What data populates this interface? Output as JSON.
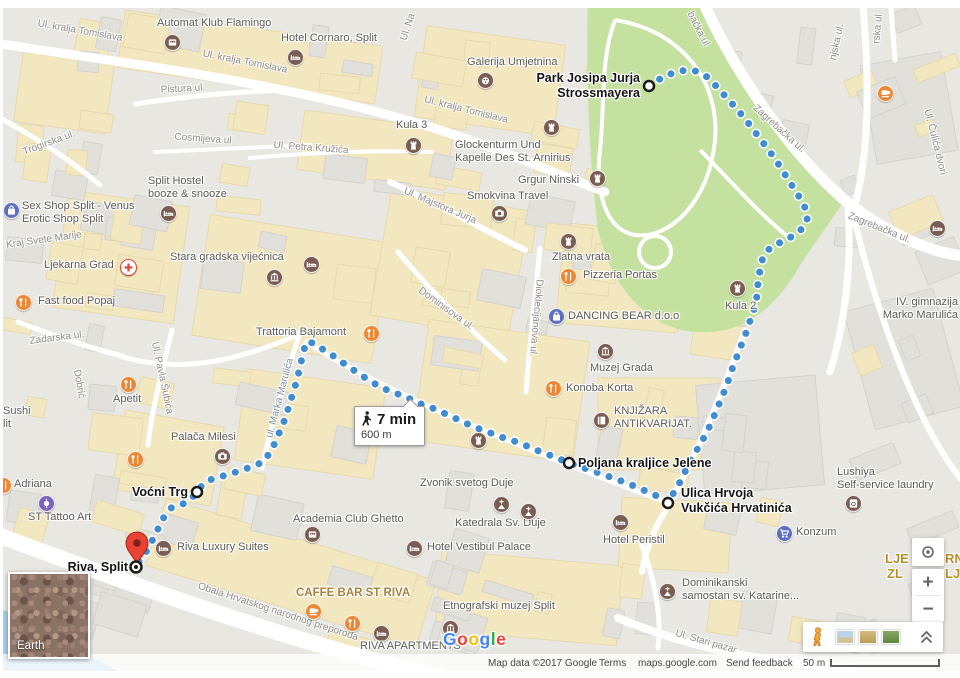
{
  "route": {
    "duration": "7 min",
    "distance": "600 m",
    "points": [
      [
        649,
        86
      ],
      [
        663,
        77
      ],
      [
        678,
        71
      ],
      [
        693,
        70
      ],
      [
        706,
        76
      ],
      [
        716,
        86
      ],
      [
        726,
        97
      ],
      [
        736,
        108
      ],
      [
        746,
        120
      ],
      [
        755,
        132
      ],
      [
        764,
        144
      ],
      [
        773,
        156
      ],
      [
        781,
        168
      ],
      [
        789,
        181
      ],
      [
        797,
        193
      ],
      [
        804,
        205
      ],
      [
        808,
        217
      ],
      [
        803,
        228
      ],
      [
        793,
        236
      ],
      [
        781,
        242
      ],
      [
        770,
        248
      ],
      [
        763,
        257
      ],
      [
        760,
        270
      ],
      [
        758,
        283
      ],
      [
        757,
        296
      ],
      [
        754,
        309
      ],
      [
        750,
        321
      ],
      [
        746,
        333
      ],
      [
        741,
        346
      ],
      [
        736,
        359
      ],
      [
        731,
        372
      ],
      [
        727,
        385
      ],
      [
        722,
        397
      ],
      [
        717,
        409
      ],
      [
        712,
        421
      ],
      [
        707,
        432
      ],
      [
        701,
        443
      ],
      [
        695,
        453
      ],
      [
        689,
        463
      ],
      [
        684,
        474
      ],
      [
        679,
        484
      ],
      [
        673,
        494
      ],
      [
        668,
        503
      ],
      [
        655,
        495
      ],
      [
        641,
        489
      ],
      [
        627,
        483
      ],
      [
        613,
        478
      ],
      [
        599,
        473
      ],
      [
        584,
        468
      ],
      [
        569,
        463
      ],
      [
        555,
        457
      ],
      [
        541,
        452
      ],
      [
        527,
        446
      ],
      [
        514,
        441
      ],
      [
        501,
        437
      ],
      [
        488,
        432
      ],
      [
        474,
        427
      ],
      [
        461,
        421
      ],
      [
        448,
        415
      ],
      [
        435,
        409
      ],
      [
        421,
        404
      ],
      [
        408,
        398
      ],
      [
        395,
        393
      ],
      [
        382,
        388
      ],
      [
        370,
        381
      ],
      [
        358,
        373
      ],
      [
        346,
        365
      ],
      [
        335,
        357
      ],
      [
        324,
        350
      ],
      [
        313,
        343
      ],
      [
        306,
        342
      ],
      [
        303,
        354
      ],
      [
        300,
        367
      ],
      [
        297,
        380
      ],
      [
        293,
        393
      ],
      [
        289,
        406
      ],
      [
        285,
        419
      ],
      [
        280,
        431
      ],
      [
        275,
        443
      ],
      [
        269,
        454
      ],
      [
        263,
        462
      ],
      [
        251,
        467
      ],
      [
        239,
        471
      ],
      [
        227,
        475
      ],
      [
        214,
        478
      ],
      [
        203,
        484
      ],
      [
        197,
        492
      ],
      [
        190,
        500
      ],
      [
        181,
        505
      ],
      [
        171,
        508
      ],
      [
        164,
        517
      ],
      [
        158,
        529
      ],
      [
        152,
        541
      ],
      [
        146,
        552
      ],
      [
        140,
        560
      ],
      [
        136,
        567
      ]
    ],
    "waypoints": [
      {
        "name": "park-josipa-jurja-strossmayera",
        "lines": [
          "Park Josipa Jurja",
          "Strossmayera"
        ],
        "cx": 649,
        "cy": 86,
        "label": {
          "x": 640,
          "y": 71,
          "align": "right"
        }
      },
      {
        "name": "poljana-kraljice-jelene",
        "lines": [
          "Poljana kraljice Jelene"
        ],
        "cx": 569,
        "cy": 463,
        "label": {
          "x": 578,
          "y": 456,
          "align": "left"
        }
      },
      {
        "name": "ulica-hrvoja-vukcica-hrvatinica",
        "lines": [
          "Ulica Hrvoja",
          "Vukčića Hrvatinića"
        ],
        "cx": 668,
        "cy": 503,
        "label": {
          "x": 681,
          "y": 486,
          "align": "left"
        }
      },
      {
        "name": "vocni-trg",
        "lines": [
          "Voćni Trg"
        ],
        "cx": 197,
        "cy": 492,
        "label": {
          "x": 188,
          "y": 485,
          "align": "right"
        }
      },
      {
        "name": "riva-split",
        "lines": [
          "Riva, Split"
        ],
        "cx": 136,
        "cy": 567,
        "destination": true,
        "label": {
          "x": 128,
          "y": 560,
          "align": "right"
        }
      }
    ]
  },
  "bubble": {
    "duration": "7 min",
    "distance": "600 m"
  },
  "pois": [
    {
      "lines": [
        "Automat Klub Flamingo"
      ],
      "x": 157,
      "y": 17,
      "icons": [
        {
          "type": "slot",
          "x": 172,
          "y": 42
        }
      ]
    },
    {
      "lines": [
        "Hotel Cornaro, Split"
      ],
      "x": 281,
      "y": 32,
      "icons": [
        {
          "type": "hotel",
          "x": 295,
          "y": 57
        }
      ]
    },
    {
      "lines": [
        "Kula 3"
      ],
      "x": 396,
      "y": 119,
      "icons": [
        {
          "type": "castle",
          "x": 413,
          "y": 145
        }
      ]
    },
    {
      "lines": [
        "Galerija Umjetnina"
      ],
      "x": 467,
      "y": 56,
      "icons": [
        {
          "type": "art",
          "x": 485,
          "y": 80
        }
      ]
    },
    {
      "lines": [
        "Glockenturm Und",
        "Kapelle Des St. Arnirius"
      ],
      "x": 455,
      "y": 139,
      "icons": [
        {
          "type": "castle",
          "x": 551,
          "y": 127
        }
      ]
    },
    {
      "lines": [
        "Grgur Ninski"
      ],
      "x": 518,
      "y": 174,
      "icons": [
        {
          "type": "castle",
          "x": 597,
          "y": 178
        }
      ]
    },
    {
      "lines": [
        "Smokvina Travel"
      ],
      "x": 467,
      "y": 190,
      "icons": [
        {
          "type": "camera",
          "x": 499,
          "y": 213
        }
      ]
    },
    {
      "lines": [
        "Sex Shop Split - Venus",
        "Erotic Shop Split"
      ],
      "x": 22,
      "y": 200,
      "icons": [
        {
          "type": "bag",
          "x": 11,
          "y": 210
        }
      ]
    },
    {
      "lines": [
        "Split Hostel",
        "booze & snooze"
      ],
      "x": 148,
      "y": 175,
      "icons": [
        {
          "type": "hotel",
          "x": 168,
          "y": 213
        }
      ]
    },
    {
      "lines": [
        "Ljekarna Grad"
      ],
      "x": 44,
      "y": 259,
      "icons": [
        {
          "type": "pharmacy",
          "x": 128,
          "y": 267
        }
      ]
    },
    {
      "lines": [
        "Stara gradska vijećnica"
      ],
      "x": 170,
      "y": 251,
      "icons": [
        {
          "type": "museum",
          "x": 274,
          "y": 277
        },
        {
          "type": "hotel",
          "x": 311,
          "y": 264
        }
      ]
    },
    {
      "lines": [
        "Fast food Popaj"
      ],
      "x": 38,
      "y": 295,
      "icons": [
        {
          "type": "food",
          "x": 23,
          "y": 302
        }
      ]
    },
    {
      "lines": [
        "Trattoria Bajamont"
      ],
      "x": 256,
      "y": 326,
      "icons": [
        {
          "type": "food",
          "x": 371,
          "y": 333
        }
      ]
    },
    {
      "lines": [
        "Apetit"
      ],
      "x": 113,
      "y": 393,
      "icons": [
        {
          "type": "food",
          "x": 128,
          "y": 384
        }
      ]
    },
    {
      "lines": [
        "Palača Milesi"
      ],
      "x": 171,
      "y": 431,
      "icons": [
        {
          "type": "camera",
          "x": 222,
          "y": 456
        }
      ]
    },
    {
      "lines": [
        "Pizzeria Portas"
      ],
      "x": 583,
      "y": 269,
      "icons": [
        {
          "type": "food",
          "x": 568,
          "y": 276
        }
      ]
    },
    {
      "lines": [
        "Zlatna vrata"
      ],
      "x": 552,
      "y": 251,
      "icons": [
        {
          "type": "castle",
          "x": 568,
          "y": 241
        }
      ]
    },
    {
      "lines": [
        "DANCING BEAR d.o.o"
      ],
      "x": 568,
      "y": 310,
      "icons": [
        {
          "type": "bag",
          "x": 556,
          "y": 316
        }
      ]
    },
    {
      "lines": [
        "Kula 2"
      ],
      "x": 725,
      "y": 300,
      "icons": [
        {
          "type": "castle",
          "x": 737,
          "y": 288
        }
      ]
    },
    {
      "lines": [
        "Muzej Grada"
      ],
      "x": 590,
      "y": 362,
      "icons": [
        {
          "type": "museum",
          "x": 605,
          "y": 351
        }
      ]
    },
    {
      "lines": [
        "Konoba Korta"
      ],
      "x": 566,
      "y": 382,
      "icons": [
        {
          "type": "food",
          "x": 553,
          "y": 388
        }
      ]
    },
    {
      "lines": [
        "KNJIŽARA",
        "ANTIKVARIJAT."
      ],
      "x": 614,
      "y": 405,
      "icons": [
        {
          "type": "book",
          "x": 601,
          "y": 420
        }
      ]
    },
    {
      "lines": [
        "Zvonik svetog Duje"
      ],
      "x": 420,
      "y": 477,
      "icons": [
        {
          "type": "castle",
          "x": 478,
          "y": 440
        }
      ]
    },
    {
      "lines": [
        "Sushi",
        "lit"
      ],
      "x": 3,
      "y": 405,
      "icons": []
    },
    {
      "lines": [
        "Adriana"
      ],
      "x": 14,
      "y": 478,
      "icons": [
        {
          "type": "food",
          "x": 3,
          "y": 485
        }
      ]
    },
    {
      "lines": [
        "ST Tattoo Art"
      ],
      "x": 28,
      "y": 511,
      "icons": [
        {
          "type": "tattoo",
          "x": 46,
          "y": 503
        }
      ]
    },
    {
      "lines": [],
      "x": 0,
      "y": 0,
      "icons": [
        {
          "type": "food",
          "x": 135,
          "y": 459
        }
      ]
    },
    {
      "lines": [
        "Riva Luxury Suites"
      ],
      "x": 177,
      "y": 541,
      "icons": [
        {
          "type": "hotel",
          "x": 163,
          "y": 548
        }
      ]
    },
    {
      "lines": [
        "Academia Club Ghetto"
      ],
      "x": 293,
      "y": 513,
      "icons": [
        {
          "type": "slot",
          "x": 312,
          "y": 534
        }
      ]
    },
    {
      "lines": [
        "Katedrala Sv. Duje"
      ],
      "x": 455,
      "y": 517,
      "icons": [
        {
          "type": "church",
          "x": 501,
          "y": 504
        },
        {
          "type": "church",
          "x": 528,
          "y": 511
        }
      ]
    },
    {
      "lines": [
        "Hotel Vestibul Palace"
      ],
      "x": 427,
      "y": 541,
      "icons": [
        {
          "type": "hotel",
          "x": 414,
          "y": 548
        }
      ]
    },
    {
      "lines": [
        "Hotel Peristil"
      ],
      "x": 603,
      "y": 534,
      "icons": [
        {
          "type": "hotel",
          "x": 620,
          "y": 522
        }
      ]
    },
    {
      "lines": [
        "Konzum"
      ],
      "x": 796,
      "y": 526,
      "icons": [
        {
          "type": "cart",
          "x": 784,
          "y": 533
        }
      ]
    },
    {
      "lines": [
        "Dominikanski",
        "samostan sv. Katarine..."
      ],
      "x": 682,
      "y": 577,
      "icons": [
        {
          "type": "church",
          "x": 667,
          "y": 591
        }
      ]
    },
    {
      "lines": [
        "Lushiya",
        "Self-service laundry"
      ],
      "x": 837,
      "y": 466,
      "icons": [
        {
          "type": "laundry",
          "x": 853,
          "y": 503
        }
      ]
    },
    {
      "lines": [
        "CAFFE BAR ST RIVA"
      ],
      "x": 296,
      "y": 587,
      "style": "gold",
      "icons": [
        {
          "type": "cafe",
          "x": 313,
          "y": 611
        },
        {
          "type": "food",
          "x": 352,
          "y": 623
        },
        {
          "type": "hotel",
          "x": 381,
          "y": 633
        }
      ]
    },
    {
      "lines": [
        "RIVA APARTMENTS"
      ],
      "x": 360,
      "y": 640,
      "icons": [
        {
          "type": "museum",
          "x": 450,
          "y": 628
        }
      ]
    },
    {
      "lines": [
        "Etnografski muzej Split"
      ],
      "x": 443,
      "y": 600,
      "icons": []
    },
    {
      "lines": [
        "IV. gimnazija",
        "Marko Marulića"
      ],
      "x": 958,
      "y": 296,
      "align": "right",
      "icons": []
    },
    {
      "lines": [],
      "x": 0,
      "y": 0,
      "icons": [
        {
          "type": "hotel",
          "x": 937,
          "y": 228
        }
      ]
    },
    {
      "lines": [],
      "x": 0,
      "y": 0,
      "icons": [
        {
          "type": "cafe",
          "x": 885,
          "y": 93
        }
      ]
    }
  ],
  "partial_labels": [
    {
      "text": "LJE",
      "x": 885,
      "y": 552
    },
    {
      "text": "RNE",
      "x": 945,
      "y": 552
    },
    {
      "text": "ZL",
      "x": 887,
      "y": 567
    },
    {
      "text": "LJE",
      "x": 945,
      "y": 567
    }
  ],
  "streets": [
    {
      "text": "Ul. kralja Tomislava",
      "x": 80,
      "y": 31,
      "rot": 10
    },
    {
      "text": "Ul. kralja Tomislava",
      "x": 245,
      "y": 62,
      "rot": 11
    },
    {
      "text": "Ul. kralja Tomislava",
      "x": 466,
      "y": 110,
      "rot": 14
    },
    {
      "text": "Pistura ul.",
      "x": 183,
      "y": 89,
      "rot": -3
    },
    {
      "text": "Cosmijeva ul",
      "x": 203,
      "y": 139,
      "rot": 4
    },
    {
      "text": "Ul. Petra Kružića",
      "x": 311,
      "y": 148,
      "rot": 4
    },
    {
      "text": "Trogirska ul.",
      "x": 49,
      "y": 143,
      "rot": -20
    },
    {
      "text": "Kraj Svete Marije",
      "x": 44,
      "y": 240,
      "rot": -8
    },
    {
      "text": "Zadarska ul.",
      "x": 57,
      "y": 338,
      "rot": -7
    },
    {
      "text": "Dobrić",
      "x": 79,
      "y": 384,
      "rot": 80
    },
    {
      "text": "Ul. Pavla Šubića",
      "x": 162,
      "y": 378,
      "rot": 78
    },
    {
      "text": "Ul. Majstora Jurja",
      "x": 440,
      "y": 206,
      "rot": 23
    },
    {
      "text": "Dominisova ul.",
      "x": 446,
      "y": 309,
      "rot": 36
    },
    {
      "text": "Dioklecijanova ul.",
      "x": 536,
      "y": 318,
      "rot": 95
    },
    {
      "text": "ul. Marka Marulića",
      "x": 280,
      "y": 398,
      "rot": -75,
      "color": "#7b8ea6"
    },
    {
      "text": "Obala Hrvatskog narodnog preporoda",
      "x": 278,
      "y": 612,
      "rot": 18
    },
    {
      "text": "Ul. Stari pazar",
      "x": 706,
      "y": 642,
      "rot": 16
    },
    {
      "text": "Zagrebačka ul.",
      "x": 879,
      "y": 228,
      "rot": 22
    },
    {
      "text": "Zagrebačka ul.",
      "x": 779,
      "y": 129,
      "rot": 42
    },
    {
      "text": "bačka ul",
      "x": 698,
      "y": 29,
      "rot": 63
    },
    {
      "text": "Ul. Na",
      "x": 408,
      "y": 27,
      "rot": -72
    },
    {
      "text": "njska ul.",
      "x": 837,
      "y": 42,
      "rot": -78
    },
    {
      "text": "rska ul",
      "x": 878,
      "y": 29,
      "rot": -85
    },
    {
      "text": "Ul. Čulića dvori",
      "x": 935,
      "y": 142,
      "rot": 76
    }
  ],
  "earth": {
    "label": "Earth"
  },
  "logo": {
    "text": "Google"
  },
  "controls": {
    "zoom_in": "+",
    "zoom_out": "−"
  },
  "attribution": {
    "map_data": "Map data ©2017 Google",
    "terms": "Terms",
    "site": "maps.google.com",
    "feedback": "Send feedback",
    "scale_label": "50 m"
  },
  "colors": {
    "route_blue": "#3f8cd1",
    "park_green": "#c5e1a0",
    "water_blue": "#a5cdea",
    "building_cream": "#f3e7c0",
    "building_gray": "#e2e0da",
    "poi_brown": "#795c52",
    "poi_orange": "#ea8835",
    "poi_blue": "#5e6fc0",
    "poi_purple": "#7d62c4",
    "pin_red": "#EA4335"
  }
}
